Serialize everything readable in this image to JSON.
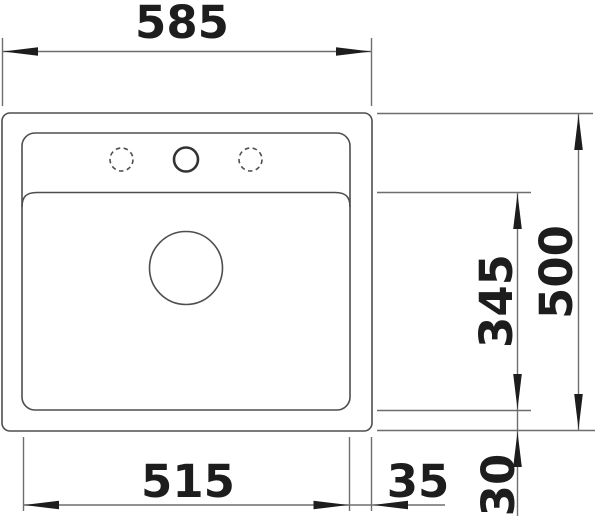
{
  "drawing": {
    "labels": {
      "overall_width": "585",
      "overall_depth": "500",
      "bowl_width": "515",
      "bowl_depth": "345",
      "rim_offset_right": "35",
      "rim_offset_bottom": "30"
    },
    "colors": {
      "background": "#ffffff",
      "outline": "#4e4e4e",
      "dimension_lines": "#6e6e6e",
      "arrows_and_text": "#1d1d1d"
    },
    "features": {
      "tap_holes": [
        {
          "position": "left",
          "style": "dashed-optional"
        },
        {
          "position": "center",
          "style": "solid"
        },
        {
          "position": "right",
          "style": "dashed-optional"
        }
      ],
      "drain": {
        "position": "center-upper-bowl",
        "style": "solid-circle"
      }
    }
  }
}
